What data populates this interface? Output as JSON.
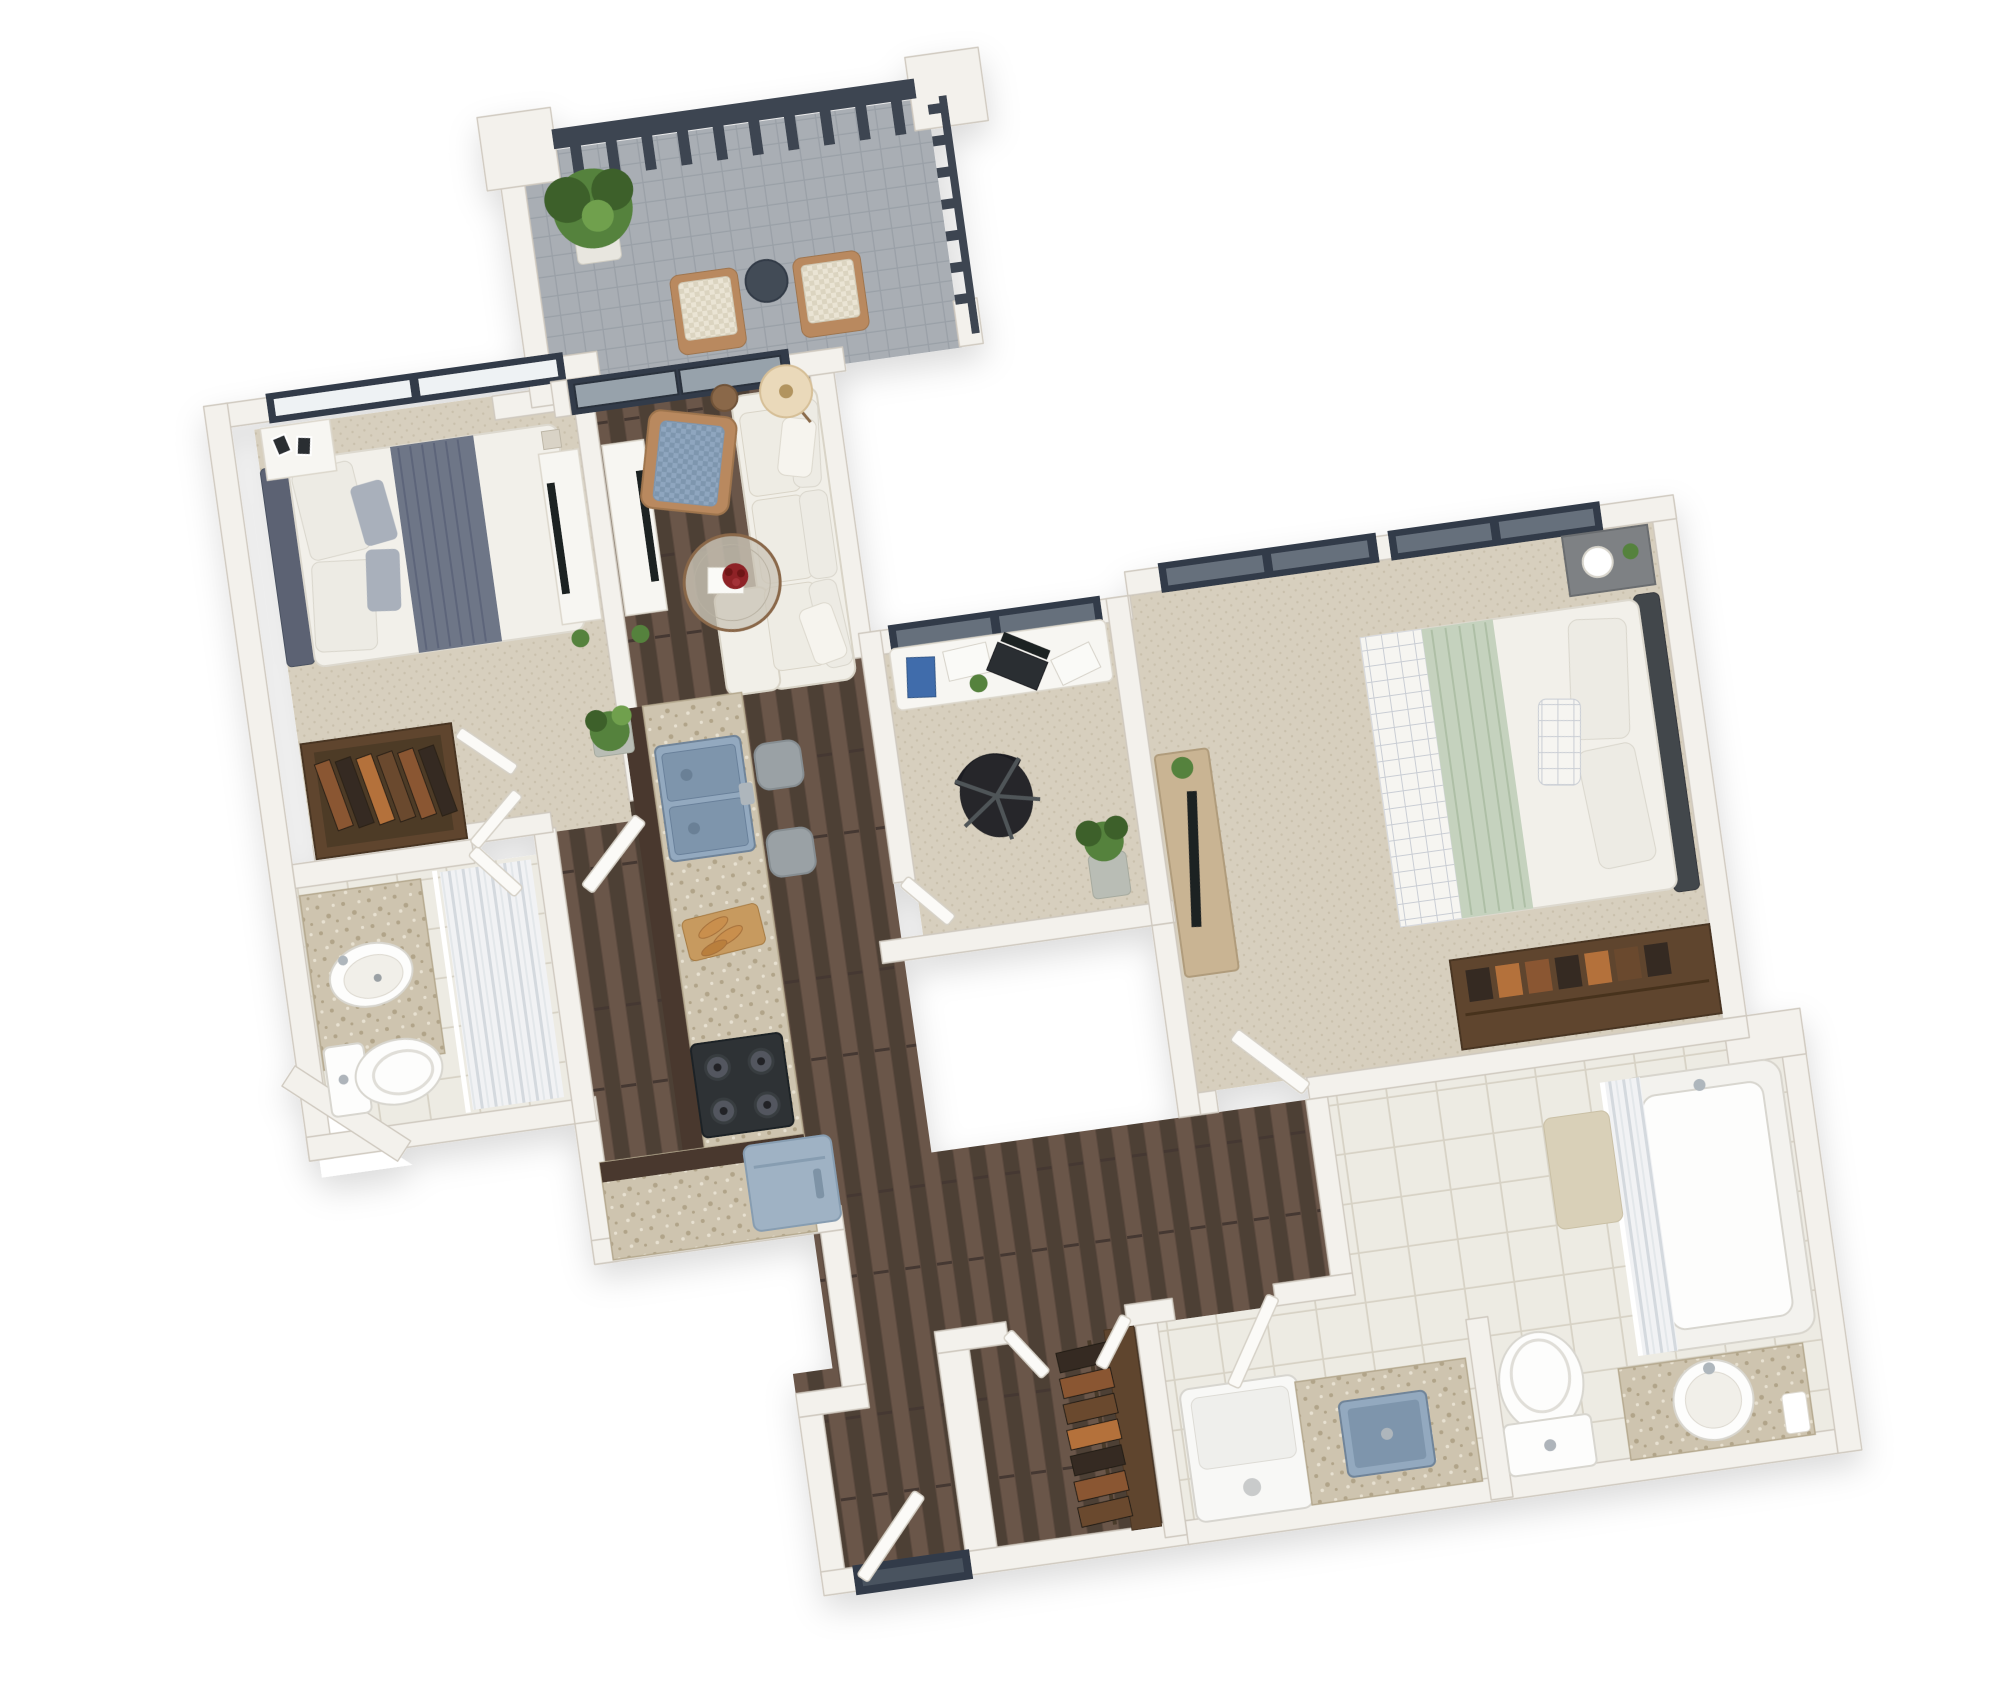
{
  "meta": {
    "title": "3D apartment floor plan render",
    "view": "top-down 3d dollhouse render",
    "rotation_deg": -8,
    "visible_text": "none"
  },
  "palette": {
    "background": "#ffffff",
    "wall": "#f3f1ec",
    "wallEdge": "#cfc9bf",
    "wallShadow": "#b8b2a6",
    "woodBase": "#5d4c41",
    "woodDark": "#4e4036",
    "woodLight": "#6a5749",
    "woodSeam": "#443830",
    "carpet": "#d7cfbe",
    "carpetDot": "#c9c0ac",
    "tile": "#edebe3",
    "grout": "#d7d2c5",
    "balconyTile": "#a9aeb4",
    "balconyGrout": "#9aa0a7",
    "granite": "#cec4af",
    "graniteDark": "#b1a489",
    "graniteLight": "#e7e0d0",
    "cabinetWood": "#4a382d",
    "frame": "#333b48",
    "glassLight": "#eef2f4",
    "glassDark": "#66707c",
    "glassMid": "#97a2ab",
    "railing": "#3d4551",
    "doorWhite": "#fbfaf7",
    "doorEdge": "#d6d1c7",
    "sofa": "#f1efe8",
    "sofaShadow": "#d9d4c7",
    "chairFabric": "#8fa6bf",
    "chairFabricDark": "#7e96ae",
    "chairWood": "#b9895e",
    "patioFabric": "#eae4d4",
    "patioFabricDark": "#dbd4c0",
    "mattress": "#f2f0ea",
    "blanketGray": "#6e7687",
    "pillowWhite": "#edebe4",
    "pillowGray": "#a9b0bb",
    "headboard1": "#5b6273",
    "headboard2": "#42464c",
    "sage": "#c5d2be",
    "throwGrid": "#f6f5f1",
    "gridLine": "#c9cdd4",
    "closetWood": "#5e452f",
    "clothesA": "#8a5632",
    "clothesB": "#342b21",
    "clothesC": "#b4713b",
    "clothesD": "#6b4a2e",
    "sinkBlue": "#93a9bf",
    "sinkBlueDark": "#7e95ac",
    "steel": "#aeb6bc",
    "stove": "#2e3134",
    "burner": "#52575e",
    "fridge": "#9fb2c4",
    "fridgeDark": "#879db1",
    "washer": "#f8f8f6",
    "stool": "#9aa1a5",
    "deskWhite": "#f7f6f2",
    "laptop": "#1f2124",
    "notebook": "#3f6cab",
    "chairBlack": "#26282b",
    "plant": "#55823c",
    "plantDark": "#3c6129",
    "pot": "#e8e6df",
    "potGray": "#b9bdb5",
    "lampShade": "#ead9ba",
    "tableWood": "#8a684a",
    "flower": "#8e2025",
    "bookWhite": "#fafaf7",
    "matBeige": "#d9d0b8",
    "porcelain": "#fdfdfc",
    "porcelainShadow": "#d8d6cf",
    "curtain": "#f1f2f4",
    "curtainLine": "#d4d9de",
    "curtainLine2": "#e3e7ea"
  },
  "rooms": [
    {
      "name": "balcony",
      "floor": "gray-tile",
      "items": [
        "potted-plant",
        "patio-chair",
        "patio-chair",
        "round-side-table",
        "dark-railing",
        "corner-pillars"
      ]
    },
    {
      "name": "living-room",
      "floor": "dark-wood",
      "items": [
        "white-sectional-sofa",
        "blue-checkered-armchair",
        "round-coffee-table-with-red-flowers",
        "floor-lamp",
        "tv-console",
        "sliding-balcony-door",
        "side-stool"
      ]
    },
    {
      "name": "master-bedroom",
      "floor": "beige-carpet",
      "items": [
        "double-bed-gray-throw",
        "dark-headboard",
        "nightstand-with-photo-frames",
        "tv-console",
        "closet-with-hanging-clothes",
        "window"
      ]
    },
    {
      "name": "master-bathroom",
      "floor": "white-tile",
      "items": [
        "granite-vanity-oval-sink",
        "toilet",
        "shower-with-curtain"
      ]
    },
    {
      "name": "kitchen",
      "floor": "dark-wood",
      "items": [
        "granite-l-counter",
        "double-blue-sink",
        "two-bar-stools",
        "gas-stove",
        "cutting-board-with-baguettes",
        "blue-fridge-cube"
      ]
    },
    {
      "name": "office",
      "floor": "beige-carpet",
      "items": [
        "white-desk",
        "black-laptop",
        "blue-notebook",
        "papers",
        "black-office-chair",
        "floor-plant",
        "window"
      ]
    },
    {
      "name": "bedroom-2",
      "floor": "beige-carpet",
      "items": [
        "bed-sage-green-blanket",
        "dark-headboard",
        "gray-nightstand-with-lamp",
        "dresser-with-tv",
        "closet-with-folded-clothes",
        "windows"
      ]
    },
    {
      "name": "bathroom-2",
      "floor": "white-tile",
      "items": [
        "bathtub-with-shower-curtain",
        "toilet",
        "granite-vanity-round-sink",
        "bath-mat"
      ]
    },
    {
      "name": "laundry",
      "floor": "white-tile",
      "items": [
        "washing-machine",
        "granite-counter-with-blue-utility-sink"
      ]
    },
    {
      "name": "hallway",
      "floor": "dark-wood",
      "items": [
        "entry-door",
        "hall-closet-hanging-clothes",
        "interior-doors"
      ]
    }
  ]
}
